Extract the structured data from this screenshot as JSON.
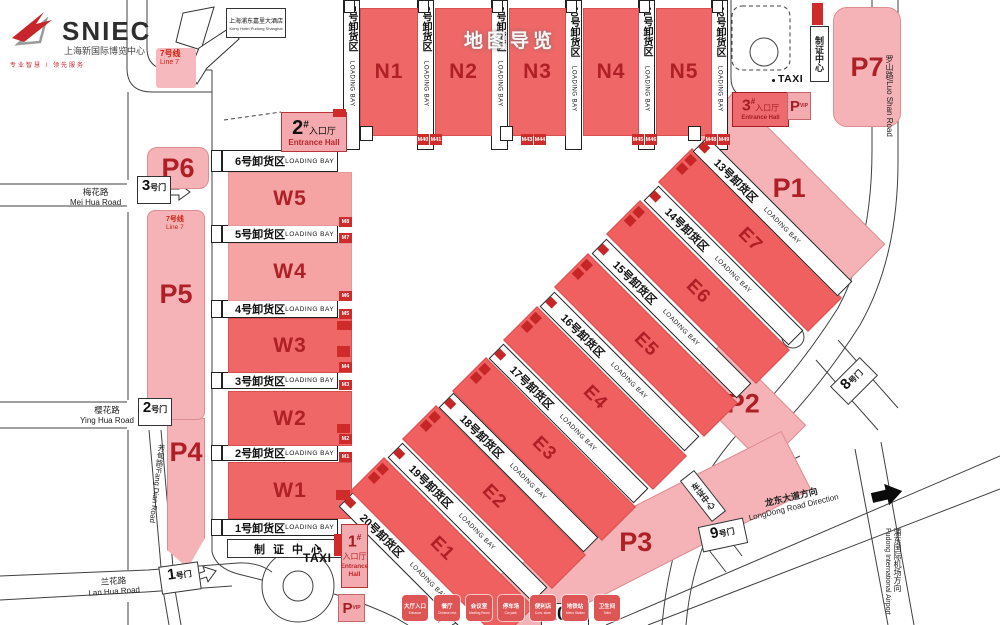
{
  "brand": {
    "name": "SNIEC",
    "cn": "上海新国际博览中心",
    "tagline": "专业智慧 / 领先服务"
  },
  "watermark": "地图导览",
  "hotel": {
    "cn": "上海浦东嘉里大酒店",
    "en": "Kerry Hotel Pudong Shanghai"
  },
  "metro": {
    "cn": "7号线",
    "en": "Line 7"
  },
  "taxi": "TAXI",
  "halls": {
    "n": [
      "N1",
      "N2",
      "N3",
      "N4",
      "N5"
    ],
    "w": [
      "W1",
      "W2",
      "W3",
      "W4",
      "W5"
    ],
    "e": [
      "E1",
      "E2",
      "E3",
      "E4",
      "E5",
      "E6",
      "E7"
    ]
  },
  "bays": {
    "en": "LOADING BAY",
    "top": [
      {
        "cn": "7号卸货区"
      },
      {
        "cn": "8号卸货区"
      },
      {
        "cn": "9号卸货区"
      },
      {
        "cn": "10号卸货区"
      },
      {
        "cn": "11号卸货区"
      },
      {
        "cn": "12号卸货区"
      }
    ],
    "west": [
      {
        "cn": "1号卸货区"
      },
      {
        "cn": "2号卸货区"
      },
      {
        "cn": "3号卸货区"
      },
      {
        "cn": "4号卸货区"
      },
      {
        "cn": "5号卸货区"
      },
      {
        "cn": "6号卸货区"
      }
    ],
    "east": [
      {
        "cn": "13号卸货区"
      },
      {
        "cn": "14号卸货区"
      },
      {
        "cn": "15号卸货区"
      },
      {
        "cn": "16号卸货区"
      },
      {
        "cn": "17号卸货区"
      },
      {
        "cn": "18号卸货区"
      },
      {
        "cn": "19号卸货区"
      },
      {
        "cn": "20号卸货区"
      }
    ]
  },
  "parking": [
    "P1",
    "P2",
    "P3",
    "P4",
    "P5",
    "P6",
    "P7"
  ],
  "vip": {
    "p": "P",
    "vip": "VIP"
  },
  "entrances": {
    "hall_cn": "入口厅",
    "hall_en": "Entrance Hall",
    "e1": "1",
    "e2": "2",
    "e3": "3",
    "hash": "#"
  },
  "gates": {
    "g1": {
      "num": "1",
      "sfx": "号门"
    },
    "g2": {
      "num": "2",
      "sfx": "号门"
    },
    "g3": {
      "num": "3",
      "sfx": "号门"
    },
    "g8": {
      "num": "8",
      "sfx": "号门"
    },
    "g9": {
      "num": "9",
      "sfx": "号门"
    },
    "g10": {
      "num": "10",
      "sfx": "号门"
    }
  },
  "centers": {
    "permit": "制证中心",
    "vehicle": "车证中心"
  },
  "roads": {
    "mei": {
      "cn": "梅花路",
      "en": "Mei Hua Road"
    },
    "ying": {
      "cn": "樱花路",
      "en": "Ying Hua Road"
    },
    "lan": {
      "cn": "兰花路",
      "en": "Lan Hua Road"
    },
    "fang": {
      "label": "芳甸路/Fang Dian Road"
    },
    "luoshan": {
      "label": "罗山路/Luo Shan Road"
    },
    "longdong": {
      "cn": "龙东大道方向",
      "en": "LongDong Road Direction"
    },
    "airport": {
      "cn": "浦东国际机场方向",
      "en": "Pudong International Airport"
    }
  },
  "m_codes": {
    "west": [
      "M1",
      "M2",
      "M3",
      "M4",
      "M5",
      "M6",
      "M7",
      "M8"
    ],
    "north": [
      "M40",
      "M41",
      "M43",
      "M44",
      "M45",
      "M46",
      "M48",
      "M49"
    ]
  },
  "legend": [
    {
      "cn": "大厅入口",
      "en": "Entrance"
    },
    {
      "cn": "餐厅",
      "en": "Chinese rest."
    },
    {
      "cn": "会议室",
      "en": "Meeting Room"
    },
    {
      "cn": "停车场",
      "en": "Car park"
    },
    {
      "cn": "便利店",
      "en": "Conv. store"
    },
    {
      "cn": "地铁站",
      "en": "Metro Station"
    },
    {
      "cn": "卫生间",
      "en": "Toilet"
    }
  ]
}
